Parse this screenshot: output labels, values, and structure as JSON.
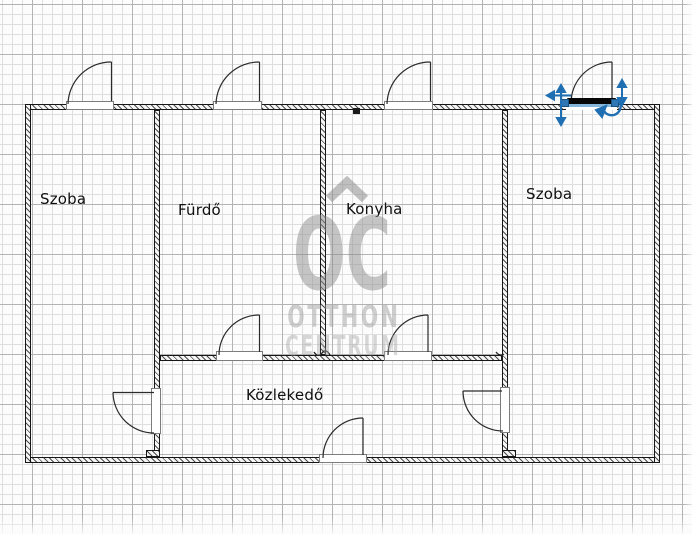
{
  "watermark": {
    "logo_text": "OC",
    "line1": "OTTHON",
    "line2": "CENTRUM"
  },
  "rooms": [
    {
      "name": "Szoba"
    },
    {
      "name": "Fürdő"
    },
    {
      "name": "Konyha"
    },
    {
      "name": "Szoba"
    },
    {
      "name": "Közlekedő"
    }
  ],
  "selection": {
    "element": "door",
    "accent_color": "#1f6fb2",
    "door_color": "#000000"
  },
  "canvas": {
    "background": "#fcfcfc",
    "grid_minor_color": "#dedede",
    "grid_major_color": "#b3b3b3",
    "wall_color": "#161616"
  }
}
